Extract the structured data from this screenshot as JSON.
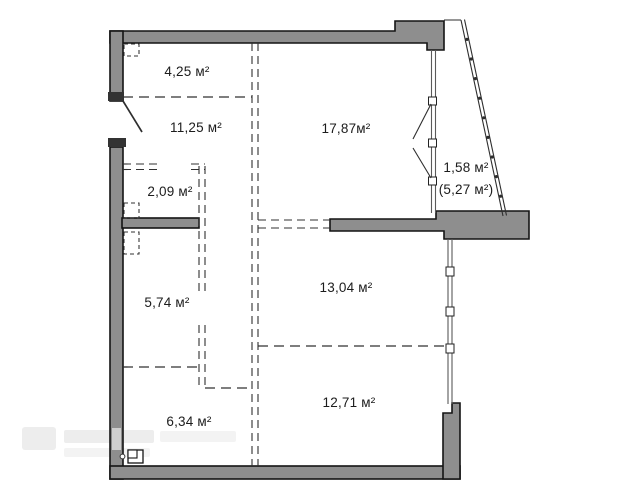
{
  "plan": {
    "type": "floor-plan",
    "unit": "м²",
    "rooms": [
      {
        "label": "4,25 м²",
        "area_m2": 4.25
      },
      {
        "label": "11,25 м²",
        "area_m2": 11.25
      },
      {
        "label": "17,87м²",
        "area_m2": 17.87
      },
      {
        "label": "2,09 м²",
        "area_m2": 2.09
      },
      {
        "label": "5,74 м²",
        "area_m2": 5.74
      },
      {
        "label": "13,04 м²",
        "area_m2": 13.04
      },
      {
        "label": "6,34 м²",
        "area_m2": 6.34
      },
      {
        "label": "12,71 м²",
        "area_m2": 12.71
      }
    ],
    "balcony": {
      "label": "1,58 м²",
      "label_alt": "(5,27 м²)",
      "area_m2": 1.58,
      "area_alt_m2": 5.27
    },
    "colors": {
      "wall_fill": "#8e8e8e",
      "wall_outline": "#141414",
      "partition_dash": "#303030",
      "background": "#ffffff",
      "label_text": "#1c1c1c",
      "watermark": "#ededed"
    }
  },
  "watermark": {
    "present": true,
    "legible": false
  }
}
